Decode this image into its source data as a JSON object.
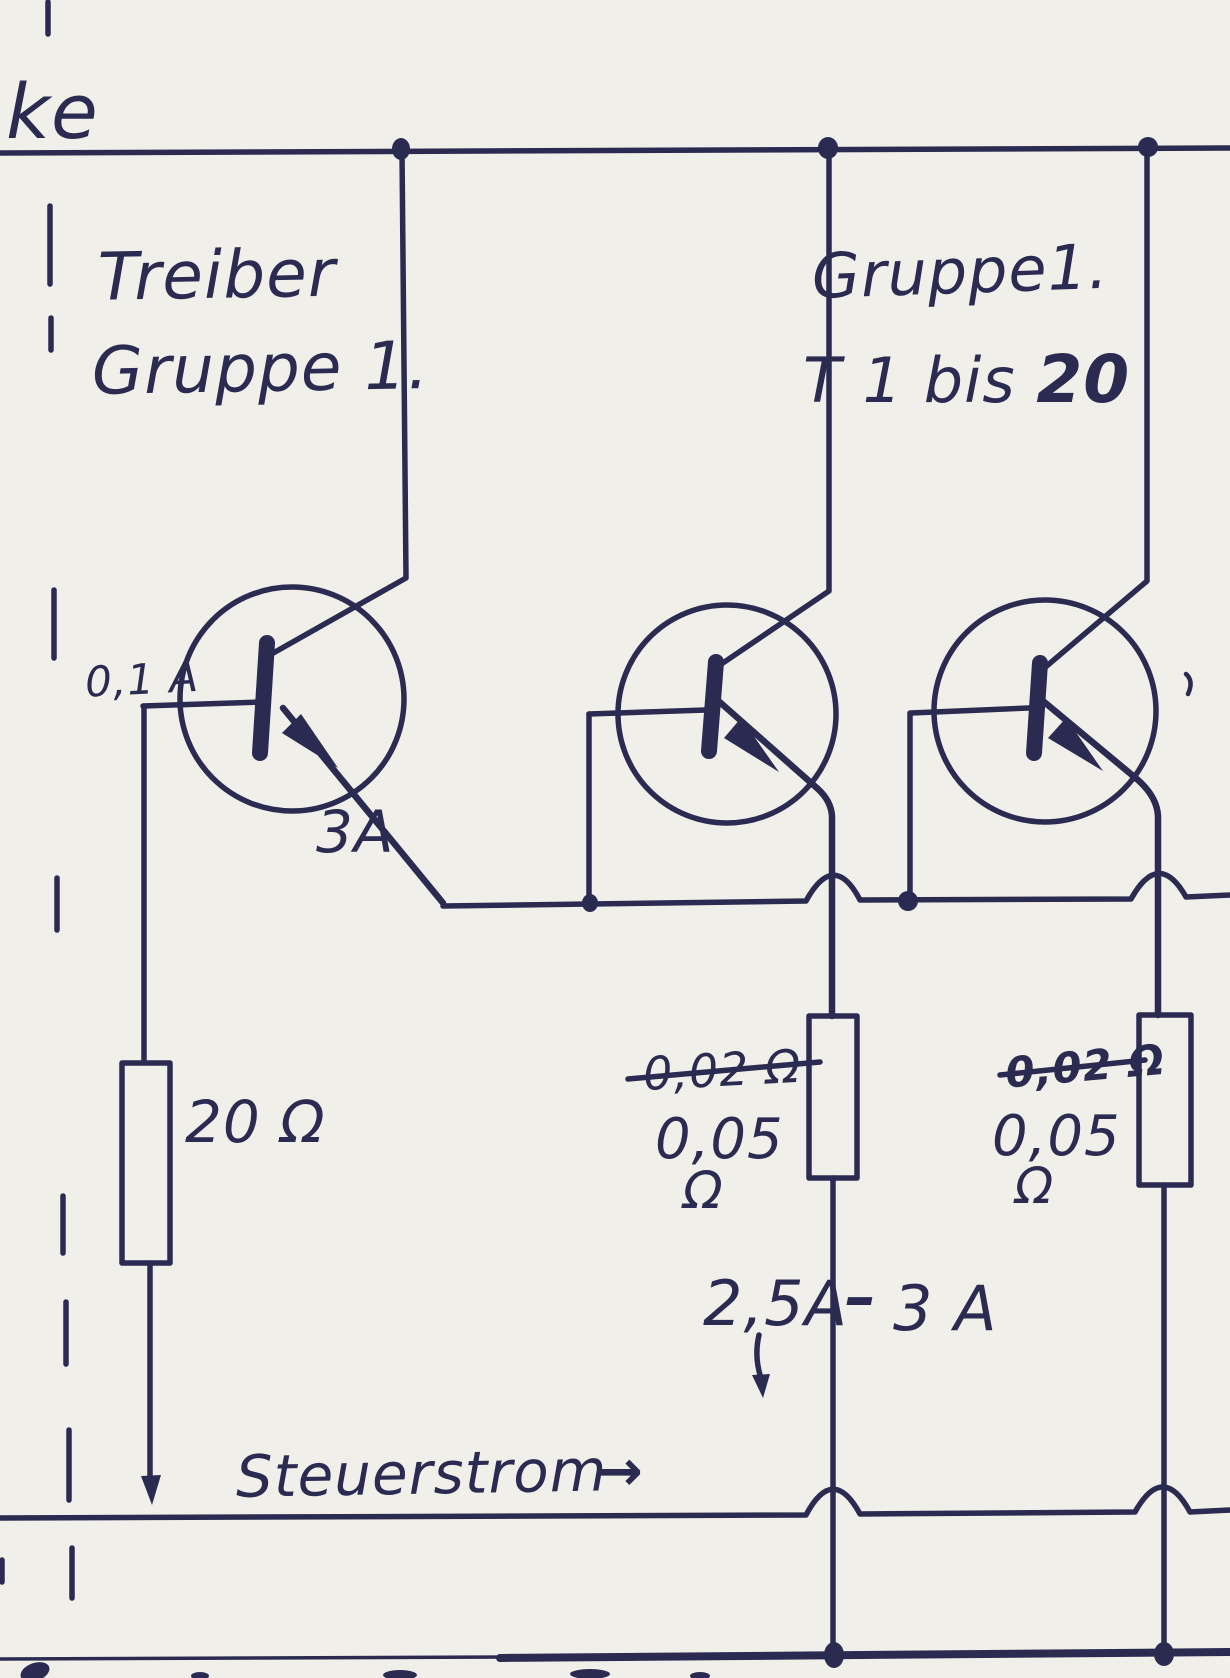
{
  "colors": {
    "ink": "#2b2b52",
    "paper": "#f0efe9"
  },
  "labels": {
    "corner": "ke",
    "driver_line1": "Treiber",
    "driver_line2": "Gruppe 1.",
    "group_line1": "Gruppe1.",
    "group_line2_prefix": "T 1 bis ",
    "group_count": "20",
    "base_current": "0,1 A",
    "driver_emitter_current": "3A",
    "driver_resistor_value": "20 Ω",
    "crossed_resistor_value": "0,02 Ω",
    "shunt_resistor_num": "0,05",
    "shunt_resistor_unit": "Ω",
    "emitter_current_low": "2,5A",
    "emitter_current_dash": "–",
    "emitter_current_high": "3 A",
    "control_current_label": "Steuerstrom"
  },
  "icons": {
    "control_current_arrow": "→",
    "current_direction_arrow": "↓"
  }
}
